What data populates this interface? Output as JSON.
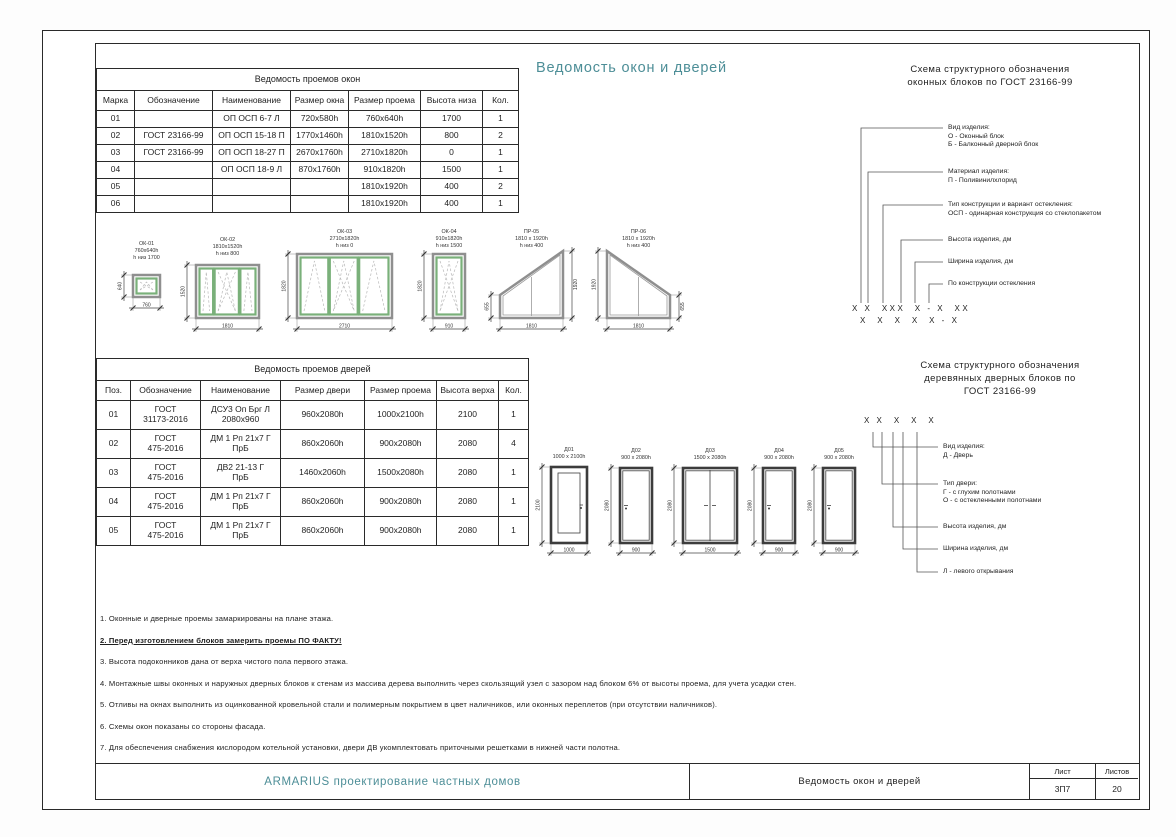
{
  "accent_teal": "#4d8e97",
  "sheet_title": "Ведомость окон и дверей",
  "windows_table": {
    "title": "Ведомость проемов окон",
    "headers": [
      "Марка",
      "Обозначение",
      "Наименование",
      "Размер окна",
      "Размер проема",
      "Высота низа",
      "Кол."
    ],
    "rows": [
      [
        "01",
        "",
        "ОП ОСП 6-7 Л",
        "720х580h",
        "760х640h",
        "1700",
        "1"
      ],
      [
        "02",
        "ГОСТ 23166-99",
        "ОП ОСП 15-18 П",
        "1770х1460h",
        "1810х1520h",
        "800",
        "2"
      ],
      [
        "03",
        "ГОСТ 23166-99",
        "ОП ОСП 18-27 П",
        "2670х1760h",
        "2710х1820h",
        "0",
        "1"
      ],
      [
        "04",
        "",
        "ОП ОСП 18-9 Л",
        "870х1760h",
        "910х1820h",
        "1500",
        "1"
      ],
      [
        "05",
        "",
        "",
        "",
        "1810х1920h",
        "400",
        "2"
      ],
      [
        "06",
        "",
        "",
        "",
        "1810х1920h",
        "400",
        "1"
      ]
    ]
  },
  "doors_table": {
    "title": "Ведомость проемов дверей",
    "headers": [
      "Поз.",
      "Обозначение",
      "Наименование",
      "Размер двери",
      "Размер проема",
      "Высота верха",
      "Кол."
    ],
    "rows": [
      [
        "01",
        "ГОСТ\n31173-2016",
        "ДСУ3 Оп Брг Л\n2080х960",
        "960х2080h",
        "1000х2100h",
        "2100",
        "1"
      ],
      [
        "02",
        "ГОСТ\n475-2016",
        "ДМ 1 Рп 21х7 Г\nПрБ",
        "860х2060h",
        "900х2080h",
        "2080",
        "4"
      ],
      [
        "03",
        "ГОСТ\n475-2016",
        "ДВ2 21-13 Г\nПрБ",
        "1460х2060h",
        "1500х2080h",
        "2080",
        "1"
      ],
      [
        "04",
        "ГОСТ\n475-2016",
        "ДМ 1 Рп 21х7 Г\nПрБ",
        "860х2060h",
        "900х2080h",
        "2080",
        "1"
      ],
      [
        "05",
        "ГОСТ\n475-2016",
        "ДМ 1 Рп 21х7 Г\nПрБ",
        "860х2060h",
        "900х2080h",
        "2080",
        "1"
      ]
    ]
  },
  "window_drawings": [
    {
      "id": "ОК-01",
      "size": "760х640h",
      "note": "h низ 1700",
      "dim_w": "760",
      "dim_v": "640"
    },
    {
      "id": "ОК-02",
      "size": "1810х1520h",
      "note": "h низ 800",
      "dim_w": "1810",
      "dim_v": "1520"
    },
    {
      "id": "ОК-03",
      "size": "2710х1820h",
      "note": "h низ 0",
      "dim_w": "2710",
      "dim_v": "1820"
    },
    {
      "id": "ОК-04",
      "size": "910х1820h",
      "note": "h низ 1500",
      "dim_w": "910",
      "dim_v": "1820"
    },
    {
      "id": "ПР-05",
      "size": "1810 х 1920h",
      "note": "h низ 400",
      "dim_w": "1810",
      "dim_v": "1920",
      "dim_v2": "655"
    },
    {
      "id": "ПР-06",
      "size": "1810 х 1920h",
      "note": "h низ 400",
      "dim_w": "1810",
      "dim_v": "1920",
      "dim_v2": "655"
    }
  ],
  "door_drawings": [
    {
      "id": "Д01",
      "size": "1000 х 2100h",
      "dim_w": "1000",
      "dim_v": "2100"
    },
    {
      "id": "Д02",
      "size": "900 х 2080h",
      "dim_w": "900",
      "dim_v": "2080"
    },
    {
      "id": "Д03",
      "size": "1500 х 2080h",
      "dim_w": "1500",
      "dim_v": "2080"
    },
    {
      "id": "Д04",
      "size": "900 х 2080h",
      "dim_w": "900",
      "dim_v": "2080"
    },
    {
      "id": "Д05",
      "size": "900 х 2080h",
      "dim_w": "900",
      "dim_v": "2080"
    }
  ],
  "window_schema": {
    "title": [
      "Схема структурного обозначения",
      "оконных блоков по ГОСТ 23166-99"
    ],
    "items": [
      {
        "lines": [
          "Вид изделия:",
          "О - Оконный блок",
          "Б - Балконный дверной блок"
        ]
      },
      {
        "lines": [
          "Материал изделия:",
          "П - Поливинилхлорид"
        ]
      },
      {
        "lines": [
          "Тип конструкции и вариант остекления:",
          "ОСП - одинарная конструкция со стеклопакетом"
        ]
      },
      {
        "lines": [
          "Высота изделия, дм"
        ]
      },
      {
        "lines": [
          "Ширина изделия, дм"
        ]
      },
      {
        "lines": [
          "По конструкции остекления"
        ]
      }
    ],
    "formulas": [
      "Х Х  ХХХ  Х - Х  ХХ",
      "Х  Х  Х  Х  Х - Х"
    ]
  },
  "door_schema": {
    "title": [
      "Схема структурного обозначения",
      "деревянных дверных блоков по",
      "ГОСТ 23166-99"
    ],
    "items": [
      {
        "lines": [
          "Вид изделия:",
          "Д - Дверь"
        ]
      },
      {
        "lines": [
          "Тип двери:",
          "Г - с глухим полотнами",
          "О - с остекленными полотнами"
        ]
      },
      {
        "lines": [
          "Высота изделия, дм"
        ]
      },
      {
        "lines": [
          "Ширина изделия, дм"
        ]
      },
      {
        "lines": [
          "Л - левого открывания"
        ]
      }
    ],
    "formulas": [
      "Х Х  Х  Х  Х"
    ]
  },
  "notes": [
    "1. Оконные и дверные проемы замаркированы на плане этажа.",
    "2. Перед изготовлением блоков замерить проемы ПО ФАКТУ!",
    "3. Высота подоконников дана от верха чистого пола первого этажа.",
    "4. Монтажные швы оконных и наружных дверных блоков к стенам из массива дерева выполнить через скользящий узел с зазором над блоком 6% от высоты проема, для учета усадки стен.",
    "5. Отливы на окнах выполнить из оцинкованной кровельной стали и полимерным покрытием в цвет наличников, или оконных переплетов (при отсутствии наличников).",
    "6. Схемы окон показаны со стороны фасада.",
    "7. Для обеспечения снабжения кислородом котельной установки, двери ДВ укомплектовать приточными решетками в нижней части полотна."
  ],
  "title_block": {
    "company": "ARMARIUS проектирование частных домов",
    "doc": "Ведомость окон и дверей",
    "sheet_label": "Лист",
    "sheets_label": "Листов",
    "sheet_no": "3П7",
    "sheets_total": "20"
  }
}
